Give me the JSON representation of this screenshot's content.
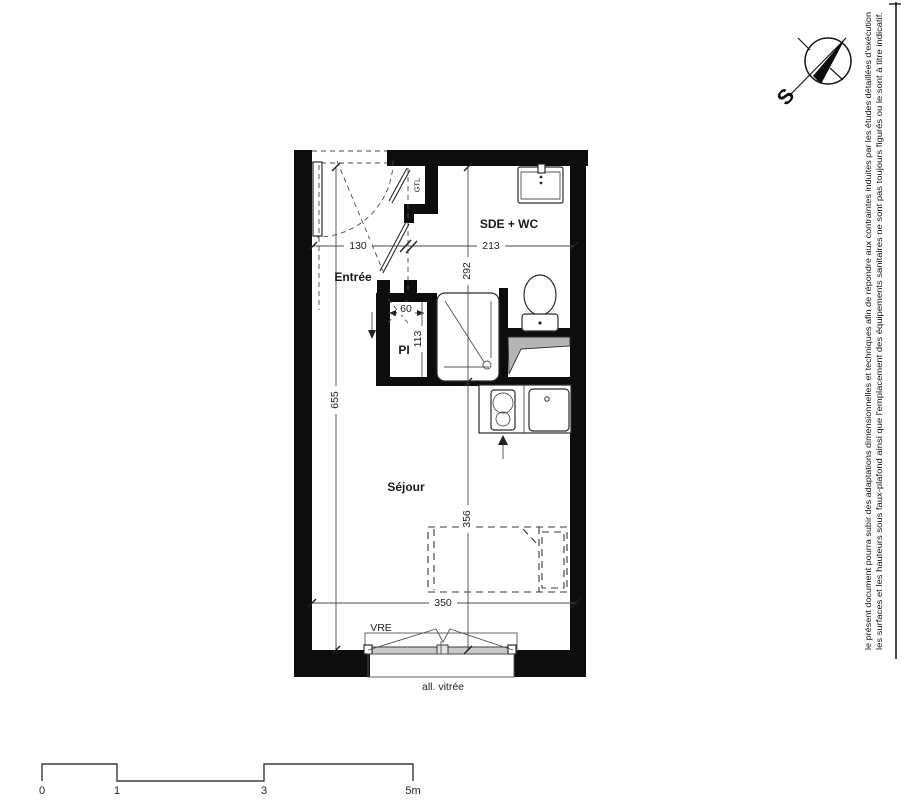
{
  "rooms": {
    "entree": "Entrée",
    "sde_wc": "SDE + WC",
    "sejour": "Séjour",
    "pi": "PI",
    "gtl": "GTL"
  },
  "dims": {
    "w_entree": "130",
    "w_sde": "213",
    "h_sde": "292",
    "w_pi": "60",
    "h_pi": "113",
    "h_total": "655",
    "h_sejour": "356",
    "w_window": "350"
  },
  "window": {
    "label": "VRE",
    "allege": "all. vitrée"
  },
  "compass": {
    "south": "S"
  },
  "scale_bar": {
    "t0": "0",
    "t1": "1",
    "t2": "3",
    "t3": "5m"
  },
  "notes": {
    "line1": "le présent document pourra subir des adaptations dimensionnelles et techniques afin de répondre aux contraintes induites par les études détaillées d'exécution",
    "line2": "les surfaces et les hauteurs sous faux-plafond ainsi que l'emplacement des équipements sanitaires ne sont pas toujours figurés ou le sont à titre indicatif."
  }
}
